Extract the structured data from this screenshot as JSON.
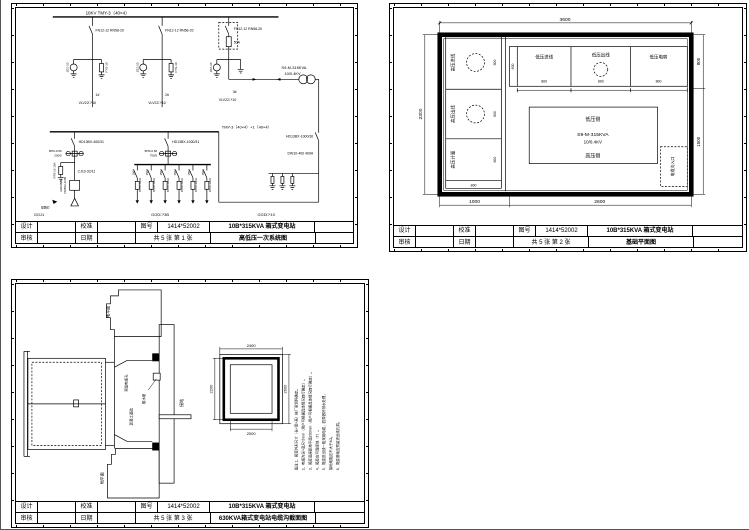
{
  "titleblock": {
    "design": "设计",
    "check": "校准",
    "drawing_no_label": "图号",
    "review": "审核",
    "date": "日期",
    "drawing_no": "1414*52002",
    "product": "10B*315KVA 箱式变电站"
  },
  "sheet1": {
    "pages": "共 5 张  第 1 张",
    "name": "高低压一次系统图",
    "bus1": "10KV  TMY-3（40×4）",
    "hv_switch": "FN12-12 RN58-20",
    "fuse3": "50A",
    "pt_label": "JDZ-10",
    "arr_label": "FYS-10",
    "cable1_no": "1#",
    "cable1": "VLV22□*10",
    "cable2_no": "2#",
    "cable2": "VLV22□*10",
    "cable3_no": "3#",
    "cable3": "VLV22□*10",
    "transformer1": "S9-M-315KVA",
    "transformer2": "10/0.4KV",
    "bus2": "TMY-3（40×4）+1（40×4）",
    "lv_switch_left": "HD13BX-400/31",
    "ct_left1": "BH0-0.66",
    "ct_left2": "200/5",
    "fuse_left": "RT8-16 10A",
    "contactor": "CJ10-32/11",
    "meter1": "DD862-4/3B",
    "meter2": "220/380V",
    "lamp": "接路灯",
    "lv_switch_right": "HD13BX-1000/31",
    "ct_right1": "BH0-0.66",
    "ct_right2": "750/5",
    "feeder_top": "150A",
    "feeder_bottom": "NT00-100A",
    "inc_switch": "HD13BX-1000/30",
    "inc_breaker": "DW10-400 400A",
    "cab1": "GGJ1",
    "cab2": "GGD□*3B",
    "cab3": "GGD□*10"
  },
  "sheet2": {
    "pages": "共 5 张  第 2 张",
    "name": "基础平面图",
    "dim_top": "3600",
    "dim_left": "2300",
    "dim_right_top": "800",
    "dim_right_bottom": "1500",
    "dim_bottom_left": "1000",
    "dim_bottom_right": "2600",
    "hv_cells": [
      "高压进线",
      "高压出线",
      "高压计量"
    ],
    "hv_dims": [
      "600",
      "600",
      "600"
    ],
    "hv_width": "800",
    "lv_cells": [
      "低压进线",
      "低压出线",
      "低压电容"
    ],
    "lv_dims": [
      "800",
      "800",
      "800"
    ],
    "lv_depth": "600",
    "tx_top": "低压侧",
    "tx_model": "S9-M-315KVA",
    "tx_volt": "10/0.4KV",
    "tx_bottom": "高压侧",
    "cable_entry": "电缆沟入口"
  },
  "sheet3": {
    "pages": "共 5 张  第 3 张",
    "name": "630KVA箱式变电站电缆沟截面图",
    "ground_top": "地平面",
    "ground_bottom": "地平面",
    "label_hole": "预留电缆孔",
    "label_apron": "散水坡",
    "label_base": "混凝土基础",
    "label_earth": "接地",
    "plan_dim_top": "2400",
    "plan_dim_right": "2600",
    "plan_dim_bottom": "2000",
    "plan_dim_left": "2200",
    "notes": [
      "备注:1、箱变外形尺寸（长×宽×高）按厂家资料确定。",
      "2、电缆沟深×宽尺寸mm（用户可根据具体情况自行确定）。",
      "3、箱变底座距地平面200mm（用户可根据具体情况自行确定）。",
      "4、箱变应可靠接地（T）。",
      "5、箱变进出线一般采用电缆，四周做好排水处理，",
      "接地电阻应不大于4Ω。",
      "6、箱变基础应预留进出线孔洞。"
    ]
  }
}
